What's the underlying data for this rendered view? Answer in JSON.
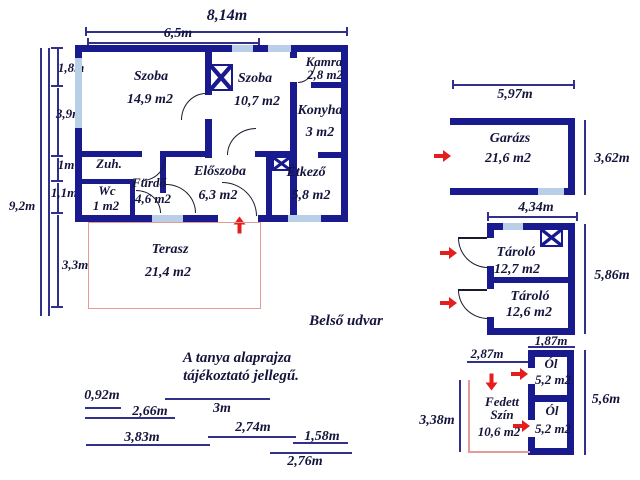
{
  "colors": {
    "wall": "#1a1a8f",
    "window": "#b9cfe8",
    "arrow_red": "#e41e1e",
    "terrace_outline": "#e59a9a",
    "dim_line": "#31318c",
    "text": "#14143c"
  },
  "note": {
    "line1": "A tanya alaprajza",
    "line2": "tájékoztató jellegű."
  },
  "courtyard_label": "Belső udvar",
  "main_house": {
    "dims": {
      "width_total": "8,14m",
      "width_inner": "6,5m",
      "height_total": "9,2m",
      "left_segments": [
        "1,8m",
        "3,9m",
        "1m",
        "1,1m",
        "3,3m"
      ]
    },
    "rooms": {
      "szoba1": {
        "name": "Szoba",
        "area": "14,9 m2"
      },
      "szoba2": {
        "name": "Szoba",
        "area": "10,7 m2"
      },
      "kamra": {
        "name": "Kamra",
        "area": "2,8 m2"
      },
      "konyha": {
        "name": "Konyha",
        "area": "3 m2"
      },
      "etkezo": {
        "name": "Étkező",
        "area": "5,8 m2"
      },
      "eloszoba": {
        "name": "Előszoba",
        "area": "6,3 m2"
      },
      "zuhany": {
        "name": "Zuh."
      },
      "wc": {
        "name": "Wc",
        "area": "1 m2"
      },
      "furdo": {
        "name": "Fürdő",
        "area": "4,6 m2"
      },
      "terasz": {
        "name": "Terasz",
        "area": "21,4 m2"
      }
    }
  },
  "garage": {
    "name": "Garázs",
    "area": "21,6 m2",
    "width_dim": "5,97m",
    "height_dim": "3,62m"
  },
  "storage": {
    "width_dim": "4,34m",
    "height_dim": "5,86m",
    "bottom_dim": "1,87m",
    "top": {
      "name": "Tároló",
      "area": "12,7 m2"
    },
    "bottom": {
      "name": "Tároló",
      "area": "12,6 m2"
    }
  },
  "coop": {
    "top_width_dim": "2,87m",
    "height_dim": "5,6m",
    "shed_height_dim": "3,38m",
    "ol_top": {
      "name": "Ól",
      "area": "5,2 m2"
    },
    "ol_bottom": {
      "name": "Ól",
      "area": "5,2 m2"
    },
    "shed": {
      "name_line1": "Fedett",
      "name_line2": "Szín",
      "area": "10,6 m2"
    }
  },
  "site_dims": [
    "0,92m",
    "2,66m",
    "3m",
    "2,74m",
    "3,83m",
    "1,58m",
    "2,76m"
  ]
}
